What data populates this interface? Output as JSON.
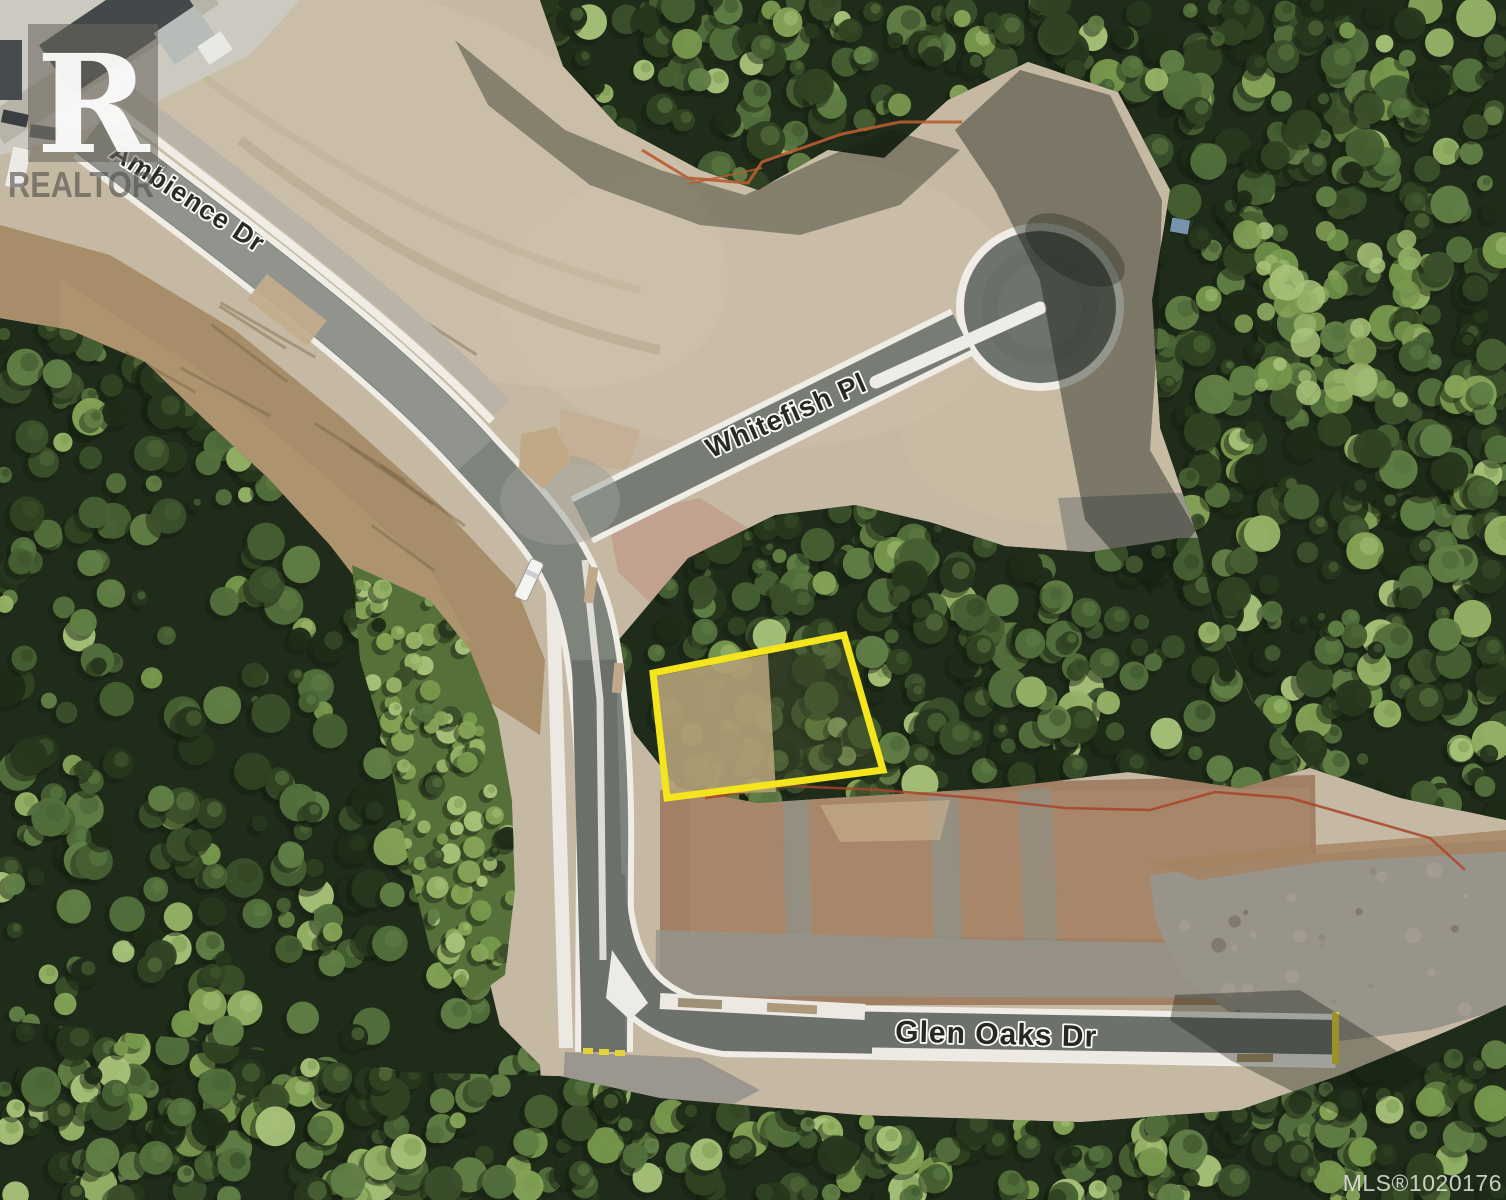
{
  "map": {
    "street_labels": [
      {
        "name": "Ambience Dr"
      },
      {
        "name": "Whitefish Pl"
      },
      {
        "name": "Glen Oaks Dr"
      }
    ],
    "mls_label": "MLS®1020176",
    "watermark": {
      "symbol_letter": "R",
      "word": "REALTOR",
      "registered": "®"
    },
    "highlight_color": "#f4e51c",
    "palette": {
      "asphalt": "#7e837c",
      "curb_white": "#efede6",
      "dirt_tan": "#c6b9a3",
      "dirt_brown": "#a78d6a",
      "lot_fill_cleared": "#b2a077",
      "forest_dark": "#1f2c1a"
    }
  }
}
